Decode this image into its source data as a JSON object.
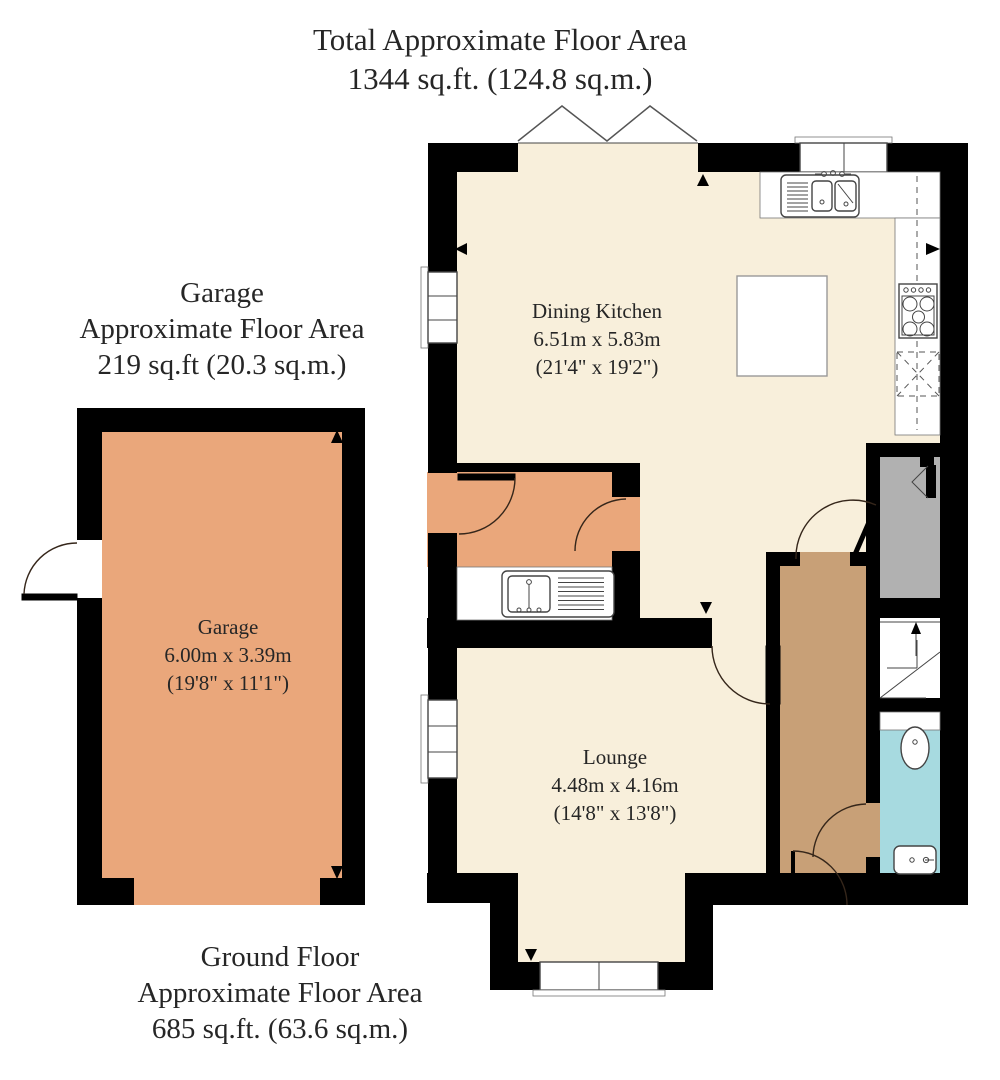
{
  "title": {
    "line1": "Total Approximate Floor Area",
    "line2": "1344 sq.ft. (124.8 sq.m.)"
  },
  "garage_area_label": {
    "line1": "Garage",
    "line2": "Approximate Floor Area",
    "line3": "219 sq.ft (20.3 sq.m.)"
  },
  "ground_floor_label": {
    "line1": "Ground Floor",
    "line2": "Approximate Floor Area",
    "line3": "685 sq.ft. (63.6 sq.m.)"
  },
  "rooms": {
    "dining_kitchen": {
      "name": "Dining Kitchen",
      "dimensions_metric": "6.51m x 5.83m",
      "dimensions_imperial": "(21'4\" x 19'2\")"
    },
    "lounge": {
      "name": "Lounge",
      "dimensions_metric": "4.48m x 4.16m",
      "dimensions_imperial": "(14'8\" x 13'8\")"
    },
    "garage": {
      "name": "Garage",
      "dimensions_metric": "6.00m x 3.39m",
      "dimensions_imperial": "(19'8\" x 11'1\")"
    }
  },
  "colors": {
    "wall": "#000000",
    "cream": "#F8EFDB",
    "orange": "#EAA77B",
    "tan": "#C8A077",
    "gray": "#B1B1B1",
    "cyan": "#A7DAE0",
    "text": "#262626"
  },
  "fixtures": [
    "double-sink-drainer",
    "single-sink-drainer",
    "four-burner-hob",
    "appliance-space",
    "kitchen-island",
    "toilet",
    "wash-basin",
    "winder-stairs",
    "window",
    "door-swing"
  ]
}
